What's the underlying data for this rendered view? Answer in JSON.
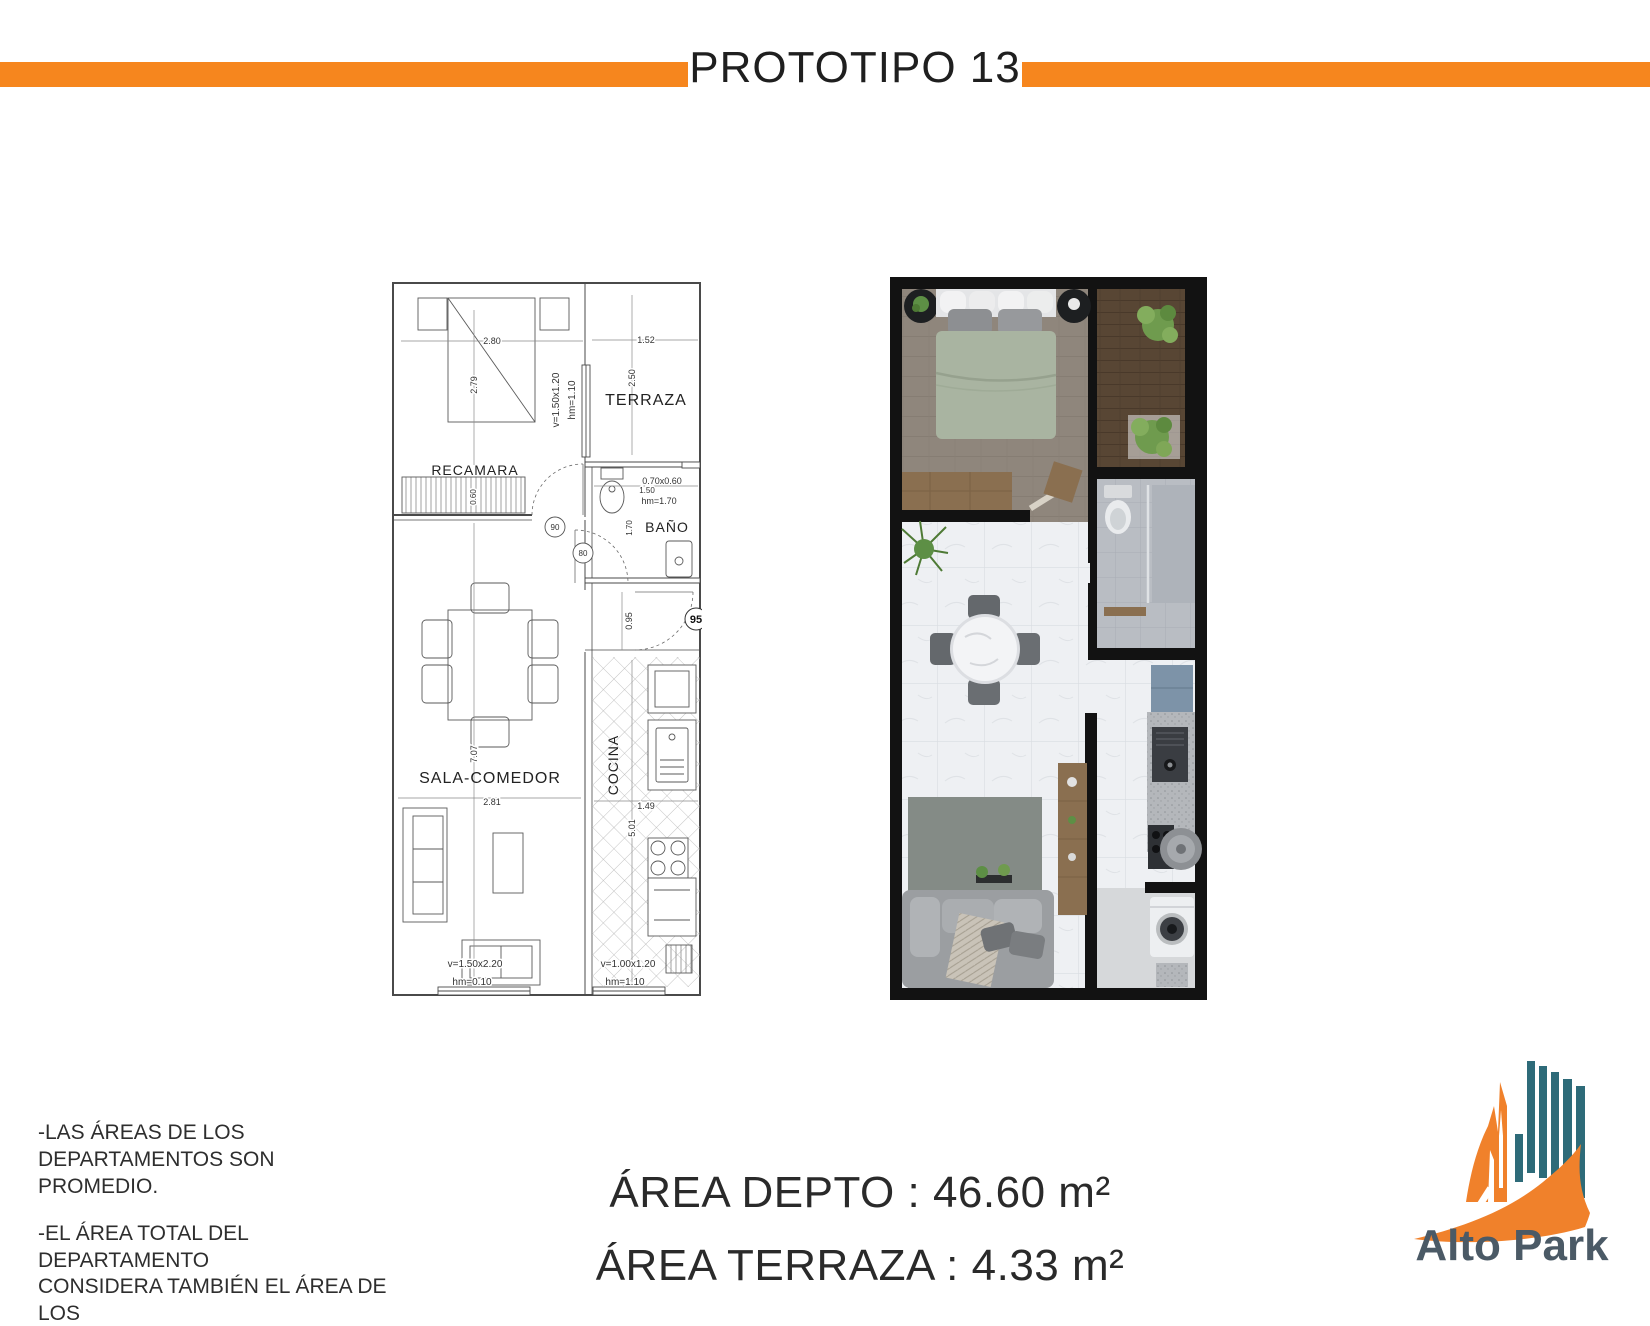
{
  "header": {
    "title": "PROTOTIPO 13"
  },
  "colors": {
    "accent_orange": "#F6861E",
    "logo_teal": "#2E6B79",
    "logo_orange": "#F0812B",
    "logo_text": "#4B5A66"
  },
  "technical_plan": {
    "room_labels": {
      "bedroom": "RECAMARA",
      "terrace": "TERRAZA",
      "bathroom": "BAÑO",
      "living": "SALA-COMEDOR",
      "kitchen": "COCINA"
    },
    "dimensions": {
      "bedroom_width": "2.80",
      "bedroom_depth": "2.79",
      "bedroom_window_size": "v=1.50x1.20",
      "bedroom_window_height": "hm=1.10",
      "closet_depth": "0.60",
      "terrace_width": "1.52",
      "terrace_depth": "2.50",
      "bath_window_size": "0.70x0.60",
      "bath_width": "1.50",
      "bath_window_height": "hm=1.70",
      "bath_depth": "1.70",
      "level_mark_90": "90",
      "level_mark_80": "80",
      "level_mark_95": "95",
      "entry_width": "0.95",
      "living_length": "7.07",
      "living_width": "2.81",
      "kitchen_width": "1.49",
      "kitchen_length": "5.01",
      "living_window_size": "v=1.50x2.20",
      "living_window_height": "hm=0.10",
      "kitchen_window_size": "v=1.00x1.20",
      "kitchen_window_height": "hm=1.10"
    }
  },
  "notes": {
    "note_1": "-LAS ÁREAS DE LOS\nDEPARTAMENTOS SON PROMEDIO.",
    "note_2": "-EL ÁREA TOTAL DEL DEPARTAMENTO\nCONSIDERA TAMBIÉN EL ÁREA DE LOS\nMUROS"
  },
  "areas": {
    "apartment": "ÁREA DEPTO : 46.60 m²",
    "terrace": "ÁREA TERRAZA : 4.33 m²"
  },
  "logo": {
    "brand": "Alto Park"
  }
}
